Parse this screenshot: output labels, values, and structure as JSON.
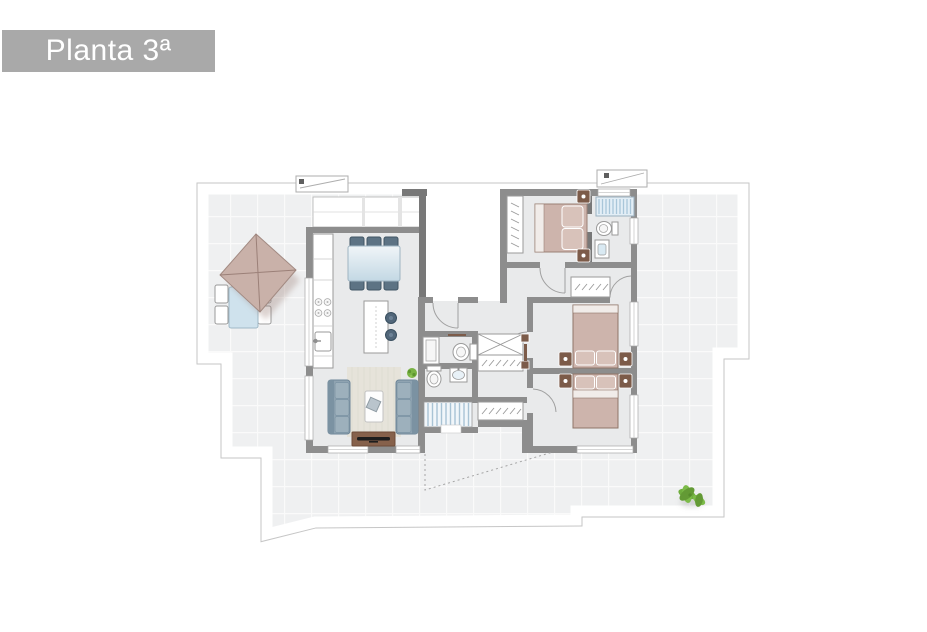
{
  "title": {
    "label": "Planta 3ª"
  },
  "plan": {
    "floor_label": "Planta 3ª",
    "rooms": [
      "terrace",
      "kitchen-dining-room",
      "living-room",
      "entry-landing",
      "hallway",
      "bathroom",
      "toilet-room",
      "bedroom-1",
      "ensuite-bathroom",
      "bedroom-2",
      "bedroom-3",
      "stairs",
      "closet-corridor"
    ],
    "furniture_symbols": [
      "parasol",
      "outdoor-table",
      "outdoor-chair",
      "dining-table",
      "dining-chair",
      "kitchen-counter",
      "cooktop",
      "kitchen-sink",
      "kitchen-island",
      "bar-stool",
      "sofa",
      "coffee-table",
      "tv-unit",
      "rug",
      "potted-plant",
      "double-bed",
      "pillow",
      "nightstand",
      "wardrobe",
      "linen-closet",
      "shower",
      "toilet",
      "washbasin",
      "stair-flight",
      "awning",
      "terrace-plant"
    ]
  },
  "colors": {
    "title_bg": "#a9a9a9",
    "title_text": "#ffffff",
    "wall": "#8d8d8d",
    "wall_dark": "#787878",
    "floor": "#e9eaeb",
    "tile": "#eff0f1",
    "grout": "#fafafa",
    "outline_gray": "#c6c6c6",
    "bed_blanket": "#cdb4ac",
    "bed_frame": "#9b8176",
    "pillow": "#d8c2ba",
    "wood": "#7c5b49",
    "sofa": "#8fa3b1",
    "sofa_dark": "#7b92a2",
    "sofa_cushion": "#9db0bc",
    "rug": "#e6e3da",
    "glass_table": "#cfe2ed",
    "dining_chair": "#5d7384",
    "stripe_bg": "#e3eef6",
    "stripe": "#a9c6d9",
    "plant_green": "#76b043",
    "plant_green_dark": "#639a35",
    "parasol": "#c9b1a9",
    "parasol_line": "#a28a82",
    "fixture_stroke": "#9a9a9a"
  }
}
